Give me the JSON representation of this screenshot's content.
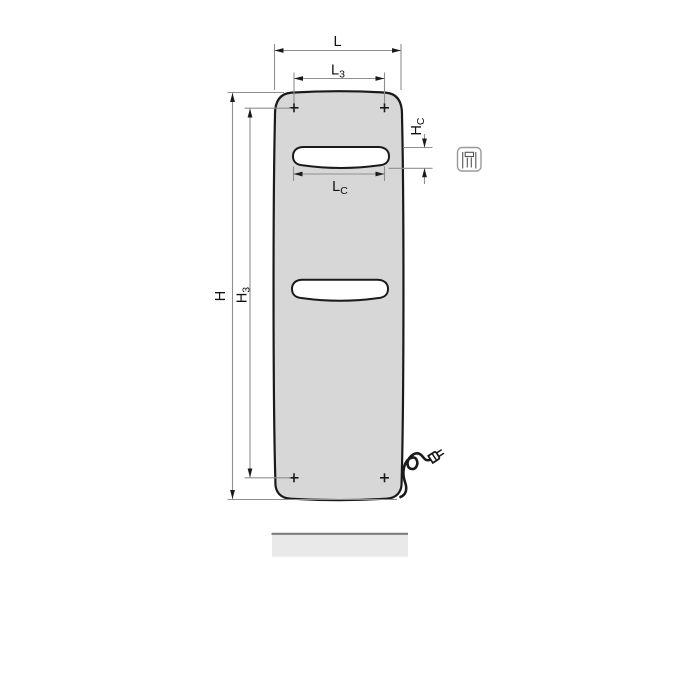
{
  "diagram": {
    "description": "technical dimension drawing of a flat panel radiator, front view"
  },
  "dims": {
    "L": {
      "base": "L",
      "sub": ""
    },
    "L3": {
      "base": "L",
      "sub": "3"
    },
    "LC": {
      "base": "L",
      "sub": "C"
    },
    "H": {
      "base": "H",
      "sub": ""
    },
    "H3": {
      "base": "H",
      "sub": "3"
    },
    "HC": {
      "base": "H",
      "sub": "C"
    }
  },
  "icons": {
    "connection_box": "radiator-connection-pictogram",
    "plug": "power-plug-icon",
    "mounting_marker": "+"
  },
  "colors": {
    "panel_fill": "#d7d7d7",
    "panel_outline": "#1a1a1a",
    "dim_line": "#8f8f8f",
    "arrow": "#1a1a1a",
    "label": "#111111",
    "cable": "#1a1a1a",
    "floor_fill": "#e9e9e9",
    "floor_edge": "#7d7d7d",
    "icon_border": "#999999",
    "icon_detail": "#555555"
  }
}
